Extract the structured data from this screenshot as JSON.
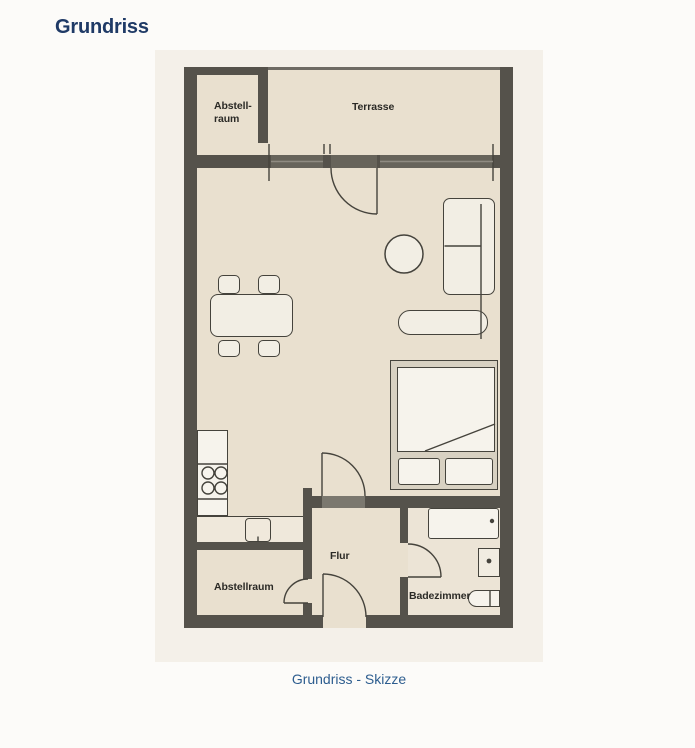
{
  "page": {
    "title": "Grundriss",
    "caption": "Grundriss - Skizze"
  },
  "floorplan": {
    "labels": {
      "storage_top_line1": "Abstell-",
      "storage_top_line2": "raum",
      "terrace": "Terrasse",
      "hallway": "Flur",
      "storage_bottom": "Abstellraum",
      "bathroom": "Badezimmer"
    },
    "colors": {
      "wall": "#55524b",
      "room": "#e9e0cf",
      "plan_background": "#f4f0e9",
      "furniture_fill": "#f2eee4",
      "outline": "#45433c",
      "title_text": "#1f3a66",
      "caption_text": "#2d5d8f",
      "page_bg": "#fcfbf9"
    }
  }
}
